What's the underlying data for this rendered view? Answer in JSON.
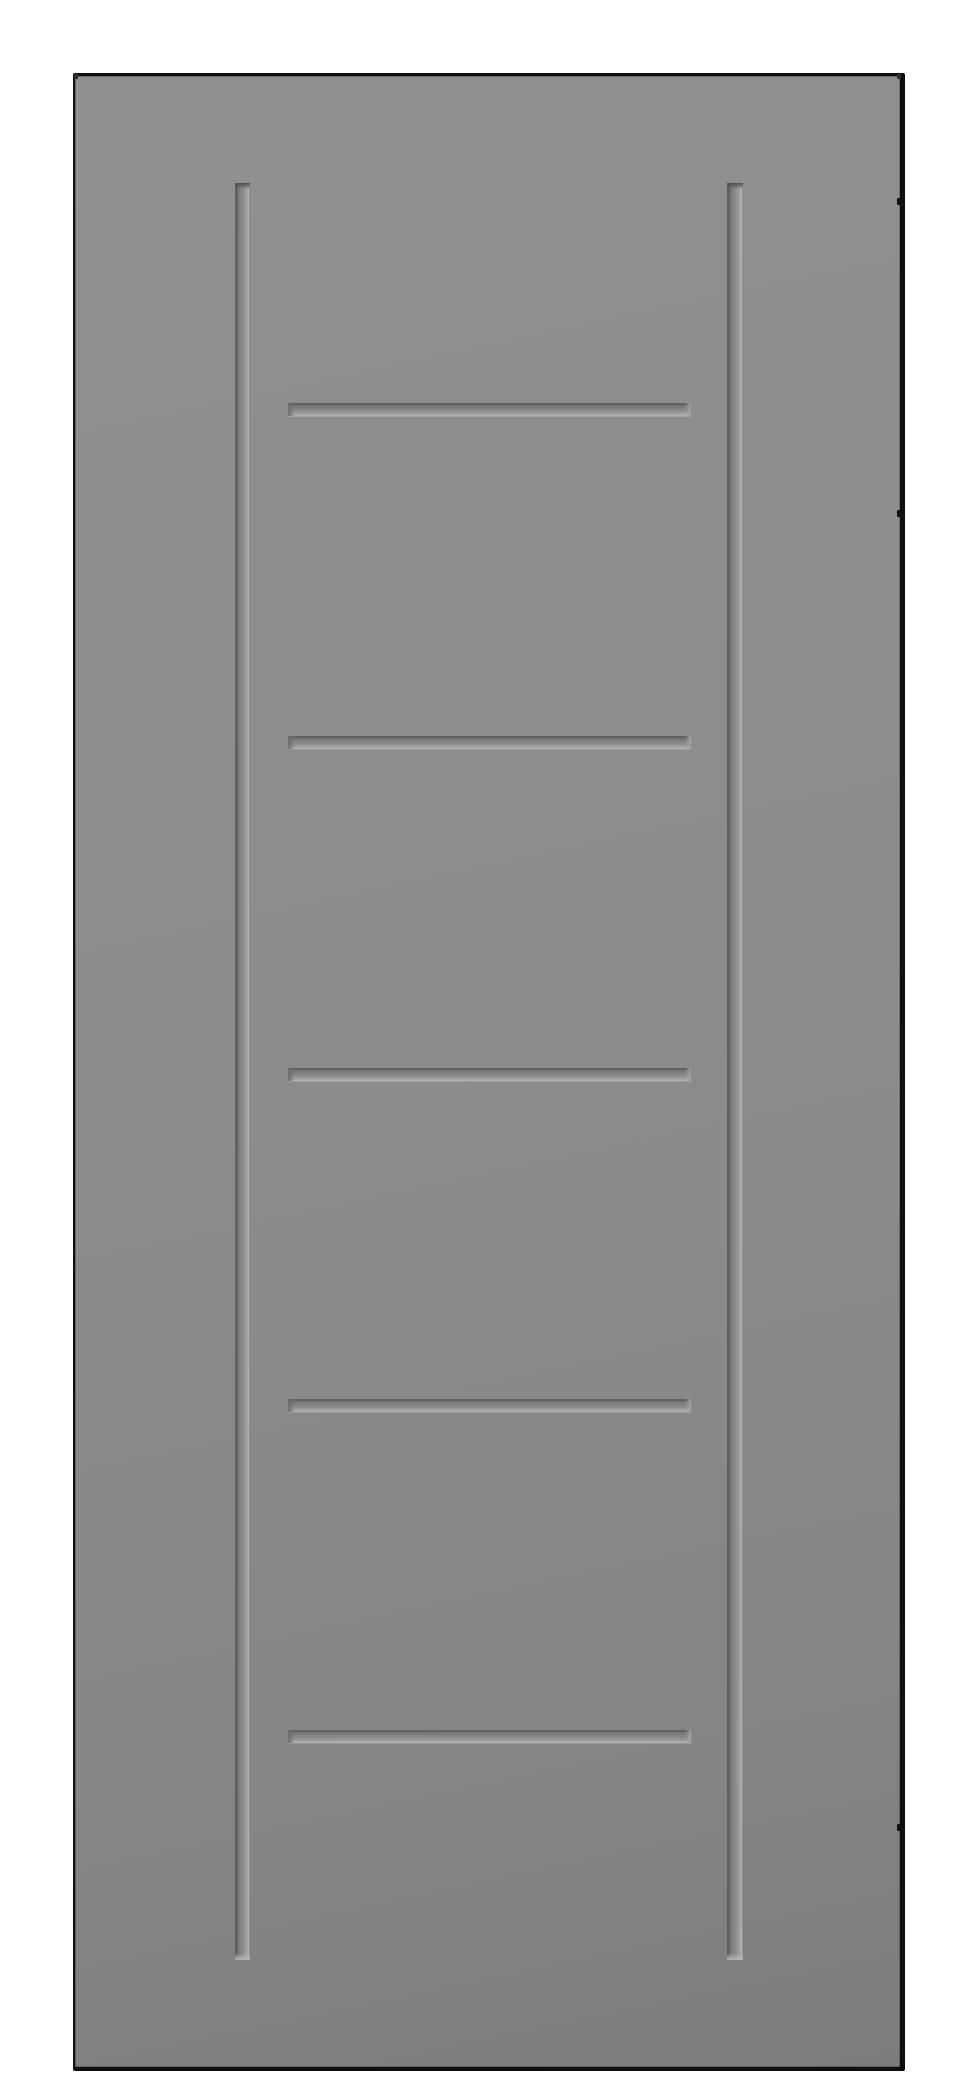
{
  "scene": {
    "description": "Product render of a flat gray interior door slab with two full-height vertical grooves, five evenly spaced horizontal grooves between them, and three small black hinge-position marks on the right edge, on a plain white background",
    "object": "door-slab",
    "text_content": "none"
  },
  "colors": {
    "background": "#ffffff",
    "door_face_light": "#909090",
    "door_face_mid": "#8c8c8c",
    "door_face_dark": "#7d7d7d",
    "edge_black": "#0f0f0f",
    "groove_shadow": "#616161",
    "groove_highlight": "#b4b4b4",
    "hinge_mark": "#101010"
  },
  "door": {
    "x": 73,
    "y": 73,
    "width": 832,
    "height": 1998,
    "vertical_grooves": [
      {
        "left": 160,
        "top": 107,
        "width": 15,
        "height": 1777
      },
      {
        "left": 652,
        "top": 107,
        "width": 16,
        "height": 1777
      }
    ],
    "horizontal_grooves": [
      {
        "left": 213,
        "top": 327,
        "width": 404,
        "height": 13
      },
      {
        "left": 213,
        "top": 660,
        "width": 404,
        "height": 13
      },
      {
        "left": 213,
        "top": 992,
        "width": 404,
        "height": 13
      },
      {
        "left": 213,
        "top": 1323,
        "width": 404,
        "height": 13
      },
      {
        "left": 213,
        "top": 1654,
        "width": 404,
        "height": 13
      }
    ],
    "hinge_marks": [
      {
        "left": 822,
        "top": 122,
        "width": 7,
        "height": 7
      },
      {
        "left": 822,
        "top": 434,
        "width": 7,
        "height": 7
      },
      {
        "left": 822,
        "top": 1748,
        "width": 7,
        "height": 7
      }
    ],
    "corner_marks": [
      {
        "left": -1,
        "top": -2,
        "width": 4,
        "height": 5
      },
      {
        "left": 822,
        "top": -2,
        "width": 4,
        "height": 5
      }
    ]
  }
}
